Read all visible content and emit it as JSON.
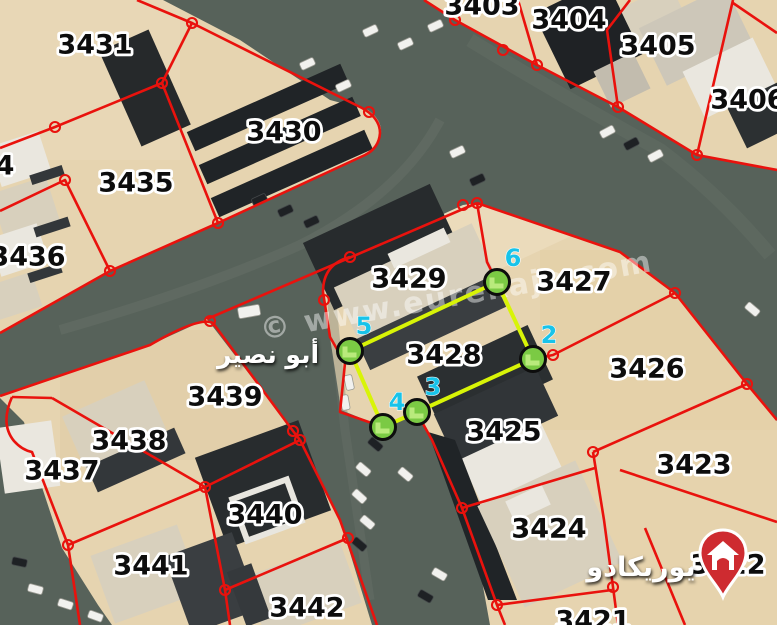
{
  "map": {
    "region_label_arabic": "أبو نصير",
    "brand_label_arabic": "يوريكادو",
    "watermark": "© www.eurekajo.com",
    "highlight": {
      "parcel_number": "3428",
      "vertices": [
        {
          "n": "5",
          "x": 350,
          "y": 351,
          "lx": 364,
          "ly": 334
        },
        {
          "n": "6",
          "x": 497,
          "y": 282,
          "lx": 513,
          "ly": 266
        },
        {
          "n": "2",
          "x": 533,
          "y": 359,
          "lx": 549,
          "ly": 343
        },
        {
          "n": "3",
          "x": 417,
          "y": 412,
          "lx": 433,
          "ly": 395
        },
        {
          "n": "4",
          "x": 383,
          "y": 427,
          "lx": 397,
          "ly": 410
        }
      ]
    },
    "parcels": [
      {
        "number": "3431",
        "x": 95,
        "y": 45
      },
      {
        "number": "3430",
        "x": 284,
        "y": 132
      },
      {
        "number": "3435",
        "x": 136,
        "y": 183
      },
      {
        "number": "4",
        "x": 5,
        "y": 166
      },
      {
        "number": "3436",
        "x": 28,
        "y": 257
      },
      {
        "number": "3403",
        "x": 482,
        "y": 6
      },
      {
        "number": "3404",
        "x": 569,
        "y": 20
      },
      {
        "number": "3405",
        "x": 658,
        "y": 46
      },
      {
        "number": "3406",
        "x": 748,
        "y": 100
      },
      {
        "number": "3429",
        "x": 409,
        "y": 279
      },
      {
        "number": "3427",
        "x": 574,
        "y": 282
      },
      {
        "number": "3428",
        "x": 444,
        "y": 355
      },
      {
        "number": "3426",
        "x": 647,
        "y": 369
      },
      {
        "number": "3439",
        "x": 225,
        "y": 397
      },
      {
        "number": "3438",
        "x": 129,
        "y": 441
      },
      {
        "number": "3437",
        "x": 62,
        "y": 471
      },
      {
        "number": "3425",
        "x": 504,
        "y": 432
      },
      {
        "number": "3423",
        "x": 694,
        "y": 465
      },
      {
        "number": "3440",
        "x": 265,
        "y": 515
      },
      {
        "number": "3424",
        "x": 549,
        "y": 529
      },
      {
        "number": "3441",
        "x": 151,
        "y": 566
      },
      {
        "number": "3442",
        "x": 307,
        "y": 608
      },
      {
        "number": "3422",
        "x": 728,
        "y": 565
      },
      {
        "number": "3421",
        "x": 593,
        "y": 621
      }
    ],
    "colors": {
      "boundary": "#e9120d",
      "highlight": "#d8f407",
      "vertex_fill": "#7bca44",
      "vertex_stroke": "#0d0d0d",
      "vertex_number": "#18c3e9",
      "label": "#0d0d0d",
      "label_halo": "#ffffff",
      "watermark": "rgba(255,255,255,0.45)",
      "sand": "#e6d4b0",
      "road": "#57625a",
      "pin": "#ce2b30"
    }
  }
}
